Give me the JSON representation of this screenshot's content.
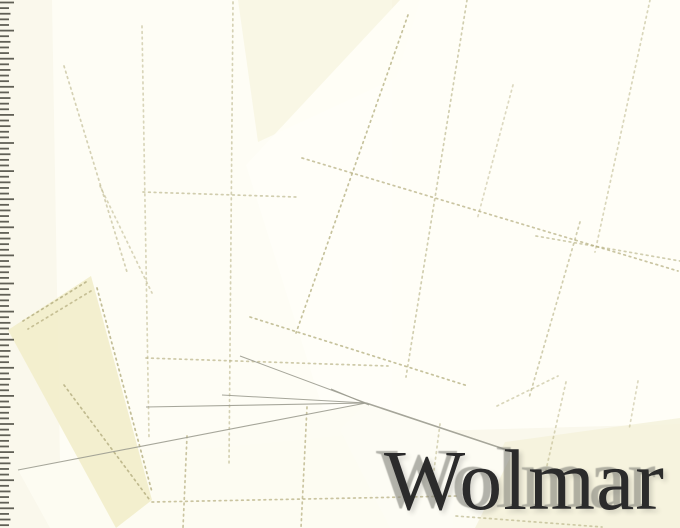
{
  "watermark": {
    "text": "Wolmar",
    "color": "#2b2b2b",
    "ghost_color": "rgba(132,132,125,0.62)",
    "soft_shadow": "rgba(40,40,40,0.18)"
  },
  "ruler": {
    "side": "left",
    "tick_count": 94,
    "tick_spacing": 5.62,
    "start_y": 2.5,
    "major_every": 5,
    "major_length": 14,
    "mid_length": 10.5,
    "minor_length": 9,
    "thickness": 1.8,
    "color": "#45453c"
  },
  "scene": {
    "width": 680,
    "height": 528,
    "background": "#faf8ec",
    "perf_color": "#b3ad7e",
    "edge_color": "#9c9c90",
    "sheets": [
      {
        "name": "sheet-left-upright",
        "points": "52,0 392,0 392,430 300,440 60,462",
        "fill": "#fefdf5",
        "opacity": 1
      },
      {
        "name": "sheet-top-center-cream",
        "points": "238,0 420,0 396,78 258,142",
        "fill": "#f6f3de",
        "opacity": 0.7
      },
      {
        "name": "sheet-right-large",
        "points": "246,165 400,0 680,0 680,424 470,430 330,432",
        "fill": "#fffef7",
        "opacity": 0.92
      },
      {
        "name": "sheet-bottom-center",
        "points": "18,470 366,403 460,434 452,528 50,528",
        "fill": "#fdfcf2",
        "opacity": 0.95
      },
      {
        "name": "sheet-bottom-right-cream",
        "points": "505,442 680,418 680,528 462,528",
        "fill": "#f5f2dc",
        "opacity": 0.85
      },
      {
        "name": "sheet-bottom-middle",
        "points": "366,403 513,452 475,528 390,528 340,430",
        "fill": "#fdfcf3",
        "opacity": 0.95
      },
      {
        "name": "sheet-bottom-left-cream",
        "points": "91,276 152,500 116,528 8,330",
        "fill": "#f2eecb",
        "opacity": 0.92
      }
    ],
    "perf_lines": [
      {
        "x1": 408,
        "y1": 15,
        "x2": 296,
        "y2": 333,
        "o": 0.75
      },
      {
        "x1": 467,
        "y1": 0,
        "x2": 406,
        "y2": 377,
        "o": 0.6
      },
      {
        "x1": 513,
        "y1": 85,
        "x2": 477,
        "y2": 220,
        "o": 0.45
      },
      {
        "x1": 650,
        "y1": 0,
        "x2": 595,
        "y2": 252,
        "o": 0.5
      },
      {
        "x1": 580,
        "y1": 222,
        "x2": 529,
        "y2": 398,
        "o": 0.6
      },
      {
        "x1": 302,
        "y1": 158,
        "x2": 678,
        "y2": 271,
        "o": 0.7
      },
      {
        "x1": 250,
        "y1": 317,
        "x2": 468,
        "y2": 386,
        "o": 0.75
      },
      {
        "x1": 536,
        "y1": 236,
        "x2": 680,
        "y2": 261,
        "o": 0.6
      },
      {
        "x1": 142,
        "y1": 26,
        "x2": 149,
        "y2": 438,
        "o": 0.5
      },
      {
        "x1": 233,
        "y1": 2,
        "x2": 229,
        "y2": 465,
        "o": 0.55
      },
      {
        "x1": 143,
        "y1": 192,
        "x2": 296,
        "y2": 197,
        "o": 0.6
      },
      {
        "x1": 146,
        "y1": 358,
        "x2": 388,
        "y2": 366,
        "o": 0.65
      },
      {
        "x1": 64,
        "y1": 66,
        "x2": 127,
        "y2": 272,
        "o": 0.55
      },
      {
        "x1": 100,
        "y1": 186,
        "x2": 152,
        "y2": 293,
        "o": 0.5
      },
      {
        "x1": 187,
        "y1": 436,
        "x2": 183,
        "y2": 528,
        "o": 0.7
      },
      {
        "x1": 307,
        "y1": 407,
        "x2": 301,
        "y2": 528,
        "o": 0.7
      },
      {
        "x1": 152,
        "y1": 502,
        "x2": 458,
        "y2": 496,
        "o": 0.7
      },
      {
        "x1": 440,
        "y1": 424,
        "x2": 433,
        "y2": 478,
        "o": 0.5
      },
      {
        "x1": 566,
        "y1": 382,
        "x2": 546,
        "y2": 470,
        "o": 0.5
      },
      {
        "x1": 638,
        "y1": 381,
        "x2": 629,
        "y2": 430,
        "o": 0.45
      },
      {
        "x1": 456,
        "y1": 516,
        "x2": 602,
        "y2": 527,
        "o": 0.6
      },
      {
        "x1": 497,
        "y1": 406,
        "x2": 558,
        "y2": 376,
        "o": 0.5
      },
      {
        "x1": 86,
        "y1": 282,
        "x2": 23,
        "y2": 321,
        "o": 0.8
      },
      {
        "x1": 91,
        "y1": 291,
        "x2": 28,
        "y2": 329,
        "o": 0.7
      },
      {
        "x1": 97,
        "y1": 288,
        "x2": 152,
        "y2": 492,
        "o": 0.8
      },
      {
        "x1": 64,
        "y1": 385,
        "x2": 149,
        "y2": 499,
        "o": 0.8
      }
    ],
    "edge_lines": [
      {
        "x1": 146,
        "y1": 407,
        "x2": 366,
        "y2": 403,
        "w": 1.1
      },
      {
        "x1": 222,
        "y1": 395,
        "x2": 366,
        "y2": 403,
        "w": 1.0
      },
      {
        "x1": 18,
        "y1": 470,
        "x2": 366,
        "y2": 403,
        "w": 1.1
      },
      {
        "x1": 331,
        "y1": 389,
        "x2": 369,
        "y2": 405,
        "w": 1.0
      },
      {
        "x1": 240,
        "y1": 356,
        "x2": 366,
        "y2": 403,
        "w": 1.0
      },
      {
        "x1": 366,
        "y1": 403,
        "x2": 513,
        "y2": 452,
        "w": 1.6
      }
    ]
  }
}
